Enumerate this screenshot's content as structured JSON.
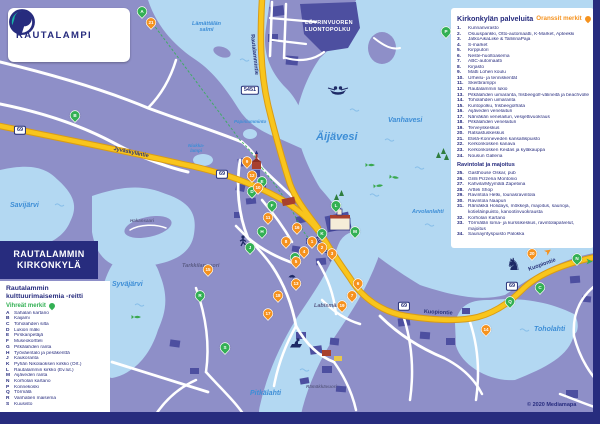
{
  "colors": {
    "navy": "#272c7e",
    "orange": "#f5921e",
    "green": "#33b054",
    "water": "#b3d8f2",
    "land": "#8e8fc8",
    "land_dark": "#4d4fa0",
    "road_yellow": "#f9c51c",
    "water_label": "#3e8ed6"
  },
  "logo": {
    "text": "RAUTALAMPI"
  },
  "title_box": {
    "line1": "RAUTALAMMIN",
    "line2": "KIRKONKYLÄ"
  },
  "left_legend": {
    "title": "Rautalammin\nkulttuurimaisemia -reitti",
    "subtitle": "Vihreät merkit",
    "items": [
      {
        "key": "A",
        "label": "Sahalan kartano"
      },
      {
        "key": "B",
        "label": "Kaijami"
      },
      {
        "key": "C",
        "label": "Toholahden silta"
      },
      {
        "key": "D",
        "label": "Lukion mäki"
      },
      {
        "key": "E",
        "label": "Pirskanpetäjä"
      },
      {
        "key": "F",
        "label": "Museokortteli"
      },
      {
        "key": "G",
        "label": "Pitkälahden ranta"
      },
      {
        "key": "H",
        "label": "Työväentalo ja pesäkenttä"
      },
      {
        "key": "J",
        "label": "Kaukoranta"
      },
      {
        "key": "K",
        "label": "Pyhän Nikolaoksen kirkko (Ort.)"
      },
      {
        "key": "L",
        "label": "Rautalammin kirkko (Ev.lut.)"
      },
      {
        "key": "M",
        "label": "Äijäveden ranta"
      },
      {
        "key": "N",
        "label": "Korholan kartano"
      },
      {
        "key": "P",
        "label": "Konnekoski"
      },
      {
        "key": "Q",
        "label": "Törmälä"
      },
      {
        "key": "R",
        "label": "Vanhatien maisema"
      },
      {
        "key": "S",
        "label": "Kuusisto"
      }
    ]
  },
  "right_legend": {
    "title": "Kirkonkylän palveluita",
    "subtitle": "Oranssit merkit",
    "services": [
      {
        "num": "1.",
        "label": "Kunnanvirasto"
      },
      {
        "num": "2.",
        "label": "Osuuspankki, Otto-automaatti, K-Market, Apteekki"
      },
      {
        "num": "3.",
        "label": "JatkoAikaLiike & TallinnaPaja"
      },
      {
        "num": "4.",
        "label": "S-market"
      },
      {
        "num": "5.",
        "label": "Kirpputori"
      },
      {
        "num": "6.",
        "label": "Neste-huoltoasema"
      },
      {
        "num": "7.",
        "label": "ABC-automaatti"
      },
      {
        "num": "8.",
        "label": "Kirjasto"
      },
      {
        "num": "9.",
        "label": "Matti Lohen koulu"
      },
      {
        "num": "10.",
        "label": "Urheilu- ja tenniskentät"
      },
      {
        "num": "11.",
        "label": "Skeittiramppi"
      },
      {
        "num": "12.",
        "label": "Rautalammin lukio"
      },
      {
        "num": "13.",
        "label": "Pitkälahden uimaranta, frisbeegolf-välineitä ja beachvolley"
      },
      {
        "num": "14.",
        "label": "Toholahden uimaranta"
      },
      {
        "num": "15.",
        "label": "Kuntopolku, frisbeegolfrata"
      },
      {
        "num": "16.",
        "label": "Äijäveden venelaituri"
      },
      {
        "num": "17.",
        "label": "Närväkän venelaituri, vesijettivuokraus"
      },
      {
        "num": "18.",
        "label": "Pitkälahden venelaituri"
      },
      {
        "num": "19.",
        "label": "Terveyskeskus"
      },
      {
        "num": "20.",
        "label": "Ratsastuskeskus"
      },
      {
        "num": "21.",
        "label": "Etelä-Konneveden kansallispuisto"
      },
      {
        "num": "22.",
        "label": "Kerkonkosken kanava"
      },
      {
        "num": "23.",
        "label": "Kerkonkosken Keidas ja kyläkauppa"
      },
      {
        "num": "24.",
        "label": "Nousun Galleria"
      }
    ],
    "subheader": "Ravintolat ja majoitus",
    "hospitality": [
      {
        "num": "25.",
        "label": "Gasthouse Oskar, pub"
      },
      {
        "num": "26.",
        "label": "Grilli Pizzeria Montonio"
      },
      {
        "num": "27.",
        "label": "Kahvila/Myymälä Zapetiina"
      },
      {
        "num": "28.",
        "label": "Artteli Shop"
      },
      {
        "num": "29.",
        "label": "Ravintola Hetki, lounasravintola"
      },
      {
        "num": "30.",
        "label": "Ravintola Naapuri"
      },
      {
        "num": "31.",
        "label": "Rämäkkä Holidays, mökkejä, majoitus, saunoja,\nkotieläinpuisto, kanootinvuokrausta"
      },
      {
        "num": "32.",
        "label": "Korholan Kartano"
      },
      {
        "num": "33.",
        "label": "Törmälän loma- ja kurssikeskus, ravintolapalvelut,\nmajoitus"
      },
      {
        "num": "34.",
        "label": "Saunayrityspuisto Palokka"
      }
    ]
  },
  "map": {
    "labels": [
      {
        "text": "Lämättälän\nsalmi",
        "x": 192,
        "y": 22,
        "cls": "water sm center"
      },
      {
        "text": "Savijärvi",
        "x": 10,
        "y": 202,
        "cls": "water md"
      },
      {
        "text": "Syväjärvi",
        "x": 112,
        "y": 281,
        "cls": "water md"
      },
      {
        "text": "Äijävesi",
        "x": 316,
        "y": 132,
        "cls": "water lg"
      },
      {
        "text": "Vanhavesi",
        "x": 388,
        "y": 117,
        "cls": "water md"
      },
      {
        "text": "Arvolanlahti",
        "x": 412,
        "y": 210,
        "cls": "water sm"
      },
      {
        "text": "Pitkälahti",
        "x": 250,
        "y": 390,
        "cls": "water md"
      },
      {
        "text": "Toholahti",
        "x": 534,
        "y": 326,
        "cls": "water md"
      },
      {
        "text": "Niukka-\nlampi",
        "x": 188,
        "y": 144,
        "cls": "water xs center"
      },
      {
        "text": "Papinlamminto",
        "x": 234,
        "y": 120,
        "cls": "water xs"
      },
      {
        "text": "Hakansaari",
        "x": 130,
        "y": 219,
        "cls": "land xs"
      },
      {
        "text": "Tarkkilanvuori",
        "x": 182,
        "y": 264,
        "cls": "land sm"
      },
      {
        "text": "Labismäki",
        "x": 314,
        "y": 304,
        "cls": "land sm"
      },
      {
        "text": "Rämäkkävuori",
        "x": 306,
        "y": 385,
        "cls": "land xs"
      },
      {
        "text": "LÖYRINVUOREN\nLUONTOPOLKU",
        "x": 305,
        "y": 20,
        "cls": "trail"
      }
    ],
    "road_labels": [
      {
        "text": "Jyväskyläntie",
        "x": 114,
        "y": 147,
        "rot": 12
      },
      {
        "text": "Rautalammintie",
        "x": 254,
        "y": 34,
        "rot": 84
      },
      {
        "text": "Kuopiontie",
        "x": 318,
        "y": 236,
        "rot": 58
      },
      {
        "text": "Kuopiontie",
        "x": 424,
        "y": 310,
        "rot": 3
      },
      {
        "text": "Kuopiontie",
        "x": 528,
        "y": 268,
        "rot": -20
      }
    ],
    "shields": [
      {
        "text": "69",
        "x": 20,
        "y": 130
      },
      {
        "text": "69",
        "x": 222,
        "y": 174
      },
      {
        "text": "69",
        "x": 404,
        "y": 306
      },
      {
        "text": "69",
        "x": 512,
        "y": 286
      },
      {
        "text": "5451",
        "x": 250,
        "y": 90
      }
    ],
    "markers": [
      {
        "t": "A",
        "c": "g",
        "x": 142,
        "y": 16
      },
      {
        "t": "B",
        "c": "g",
        "x": 75,
        "y": 120
      },
      {
        "t": "C",
        "c": "g",
        "x": 540,
        "y": 292
      },
      {
        "t": "D",
        "c": "g",
        "x": 252,
        "y": 196
      },
      {
        "t": "E",
        "c": "g",
        "x": 262,
        "y": 186
      },
      {
        "t": "F",
        "c": "g",
        "x": 272,
        "y": 210
      },
      {
        "t": "G",
        "c": "g",
        "x": 295,
        "y": 262
      },
      {
        "t": "H",
        "c": "g",
        "x": 262,
        "y": 236
      },
      {
        "t": "J",
        "c": "g",
        "x": 250,
        "y": 252
      },
      {
        "t": "K",
        "c": "g",
        "x": 322,
        "y": 238
      },
      {
        "t": "L",
        "c": "g",
        "x": 336,
        "y": 210
      },
      {
        "t": "M",
        "c": "g",
        "x": 355,
        "y": 236
      },
      {
        "t": "N",
        "c": "g",
        "x": 577,
        "y": 263
      },
      {
        "t": "P",
        "c": "g",
        "x": 446,
        "y": 36
      },
      {
        "t": "Q",
        "c": "g",
        "x": 510,
        "y": 306
      },
      {
        "t": "R",
        "c": "g",
        "x": 200,
        "y": 300
      },
      {
        "t": "S",
        "c": "g",
        "x": 225,
        "y": 352
      },
      {
        "t": "1",
        "c": "o",
        "x": 312,
        "y": 246
      },
      {
        "t": "2",
        "c": "o",
        "x": 322,
        "y": 252
      },
      {
        "t": "3",
        "c": "o",
        "x": 332,
        "y": 258
      },
      {
        "t": "4",
        "c": "o",
        "x": 304,
        "y": 256
      },
      {
        "t": "5",
        "c": "o",
        "x": 296,
        "y": 266
      },
      {
        "t": "6",
        "c": "o",
        "x": 358,
        "y": 288
      },
      {
        "t": "7",
        "c": "o",
        "x": 352,
        "y": 300
      },
      {
        "t": "8",
        "c": "o",
        "x": 286,
        "y": 246
      },
      {
        "t": "9",
        "c": "o",
        "x": 247,
        "y": 166
      },
      {
        "t": "10",
        "c": "o",
        "x": 258,
        "y": 192
      },
      {
        "t": "11",
        "c": "o",
        "x": 268,
        "y": 222
      },
      {
        "t": "12",
        "c": "o",
        "x": 252,
        "y": 180
      },
      {
        "t": "13",
        "c": "o",
        "x": 296,
        "y": 288
      },
      {
        "t": "14",
        "c": "o",
        "x": 486,
        "y": 334
      },
      {
        "t": "15",
        "c": "o",
        "x": 208,
        "y": 274
      },
      {
        "t": "16",
        "c": "o",
        "x": 297,
        "y": 232
      },
      {
        "t": "17",
        "c": "o",
        "x": 268,
        "y": 318
      },
      {
        "t": "18",
        "c": "o",
        "x": 278,
        "y": 300
      },
      {
        "t": "19",
        "c": "o",
        "x": 342,
        "y": 310
      },
      {
        "t": "20",
        "c": "o",
        "x": 532,
        "y": 258
      },
      {
        "t": "21",
        "c": "o",
        "x": 151,
        "y": 27
      }
    ],
    "arrows": [
      {
        "c": "o",
        "x": 545,
        "y": 248,
        "rot": -35
      },
      {
        "c": "g",
        "x": 586,
        "y": 258,
        "rot": 0
      }
    ]
  },
  "credit": "© 2020 Mediamapa"
}
